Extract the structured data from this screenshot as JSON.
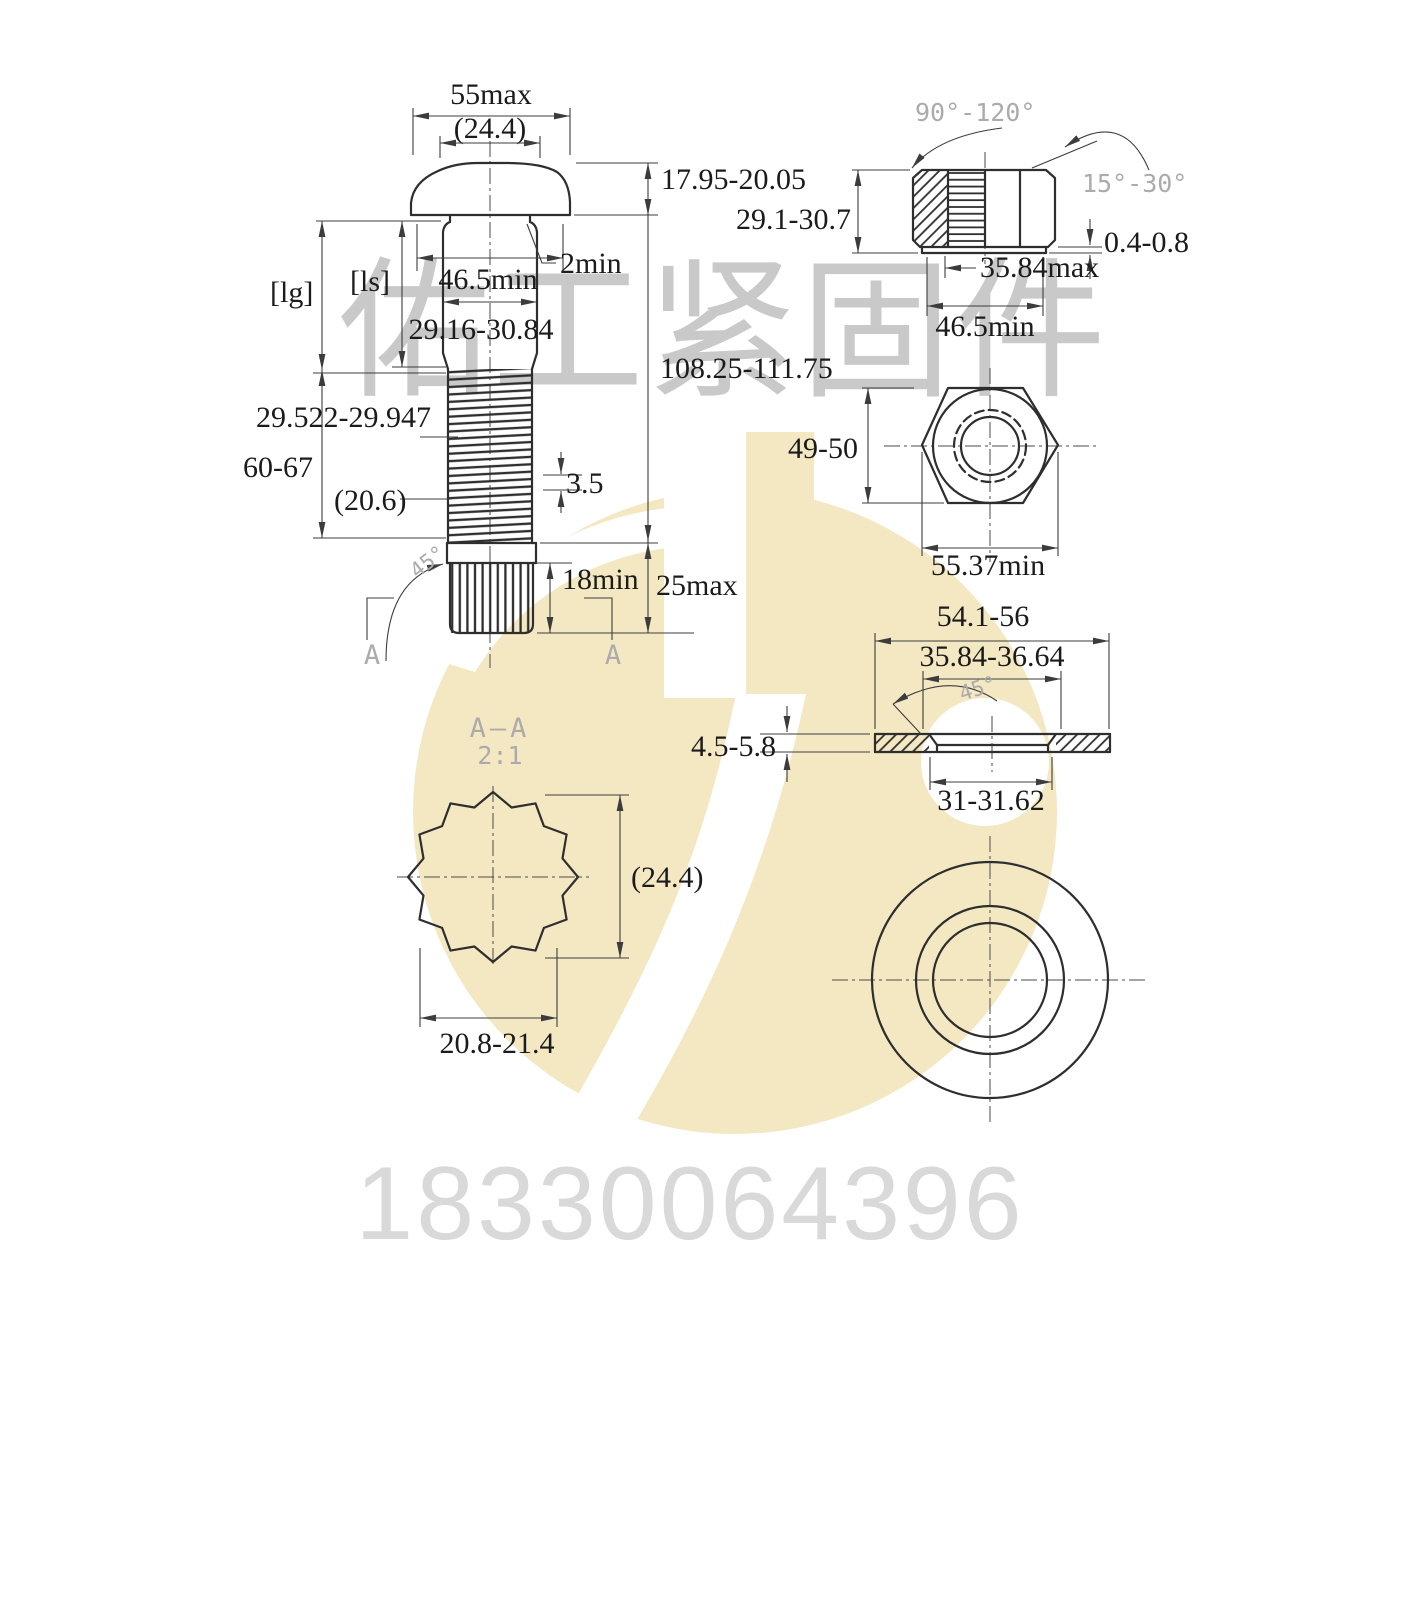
{
  "colors": {
    "line": "#2e2e2e",
    "dim_text": "#1b1b1b",
    "cad_gray": "#ababab",
    "watermark_gray": "#c9c9c9",
    "phone_gray": "#d9d9d9",
    "logo_yellow": "#f4e8c3"
  },
  "bolt": {
    "head_width": "55max",
    "head_flat": "(24.4)",
    "head_height": "17.95-20.05",
    "bearing_dia": "46.5min",
    "fillet": "2min",
    "body_dia": "29.16-30.84",
    "grip_len": "[lg]",
    "shank_len": "[ls]",
    "pitch_dia": "29.522-29.947",
    "thread_len": "60-67",
    "thread_ref": "(20.6)",
    "pitch": "3.5",
    "total_len": "108.25-111.75",
    "spline_min_len": "18min",
    "tip_len": "25max",
    "break_angle": "45°",
    "section_mark_left": "A",
    "section_mark_right": "A"
  },
  "nut": {
    "height": "29.1-30.7",
    "crown_angle": "90°-120°",
    "chamfer_angle": "15°-30°",
    "washer_face_height": "0.4-0.8",
    "washer_face_dia": "35.84max",
    "bearing_dia": "46.5min",
    "across_flats": "49-50",
    "across_corners": "55.37min"
  },
  "washer": {
    "outer_dia": "54.1-56",
    "recess_dia": "35.84-36.64",
    "chamfer_angle": "45°",
    "thickness": "4.5-5.8",
    "hole_dia": "31-31.62"
  },
  "section_view": {
    "title": "A—A",
    "scale": "2:1",
    "height_ref": "(24.4)",
    "spline_dia": "20.8-21.4"
  },
  "watermark": {
    "company": "佑工紧固件",
    "phone": "18330064396"
  }
}
